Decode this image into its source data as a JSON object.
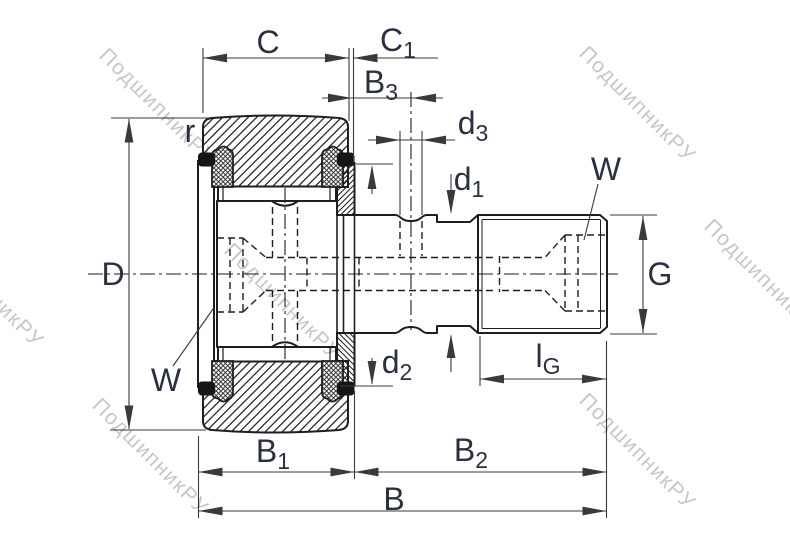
{
  "watermark": {
    "text": "ПодшипникРУ"
  },
  "colors": {
    "line": "#1e1e1e",
    "dim": "#3a3a3a",
    "label": "#2b3040",
    "watermark": "#c6c6cc",
    "lip": "#161616"
  },
  "dimension_labels": {
    "C": {
      "base": "C",
      "sub": ""
    },
    "C1": {
      "base": "C",
      "sub": "1"
    },
    "B3": {
      "base": "B",
      "sub": "3"
    },
    "d3": {
      "base": "d",
      "sub": "3"
    },
    "d1": {
      "base": "d",
      "sub": "1"
    },
    "W_top": {
      "base": "W",
      "sub": ""
    },
    "G": {
      "base": "G",
      "sub": ""
    },
    "D": {
      "base": "D",
      "sub": ""
    },
    "r": {
      "base": "r",
      "sub": ""
    },
    "W_bottom": {
      "base": "W",
      "sub": ""
    },
    "d2": {
      "base": "d",
      "sub": "2"
    },
    "lG": {
      "base": "l",
      "sub": "G"
    },
    "B1": {
      "base": "B",
      "sub": "1"
    },
    "B2": {
      "base": "B",
      "sub": "2"
    },
    "B": {
      "base": "B",
      "sub": ""
    }
  }
}
